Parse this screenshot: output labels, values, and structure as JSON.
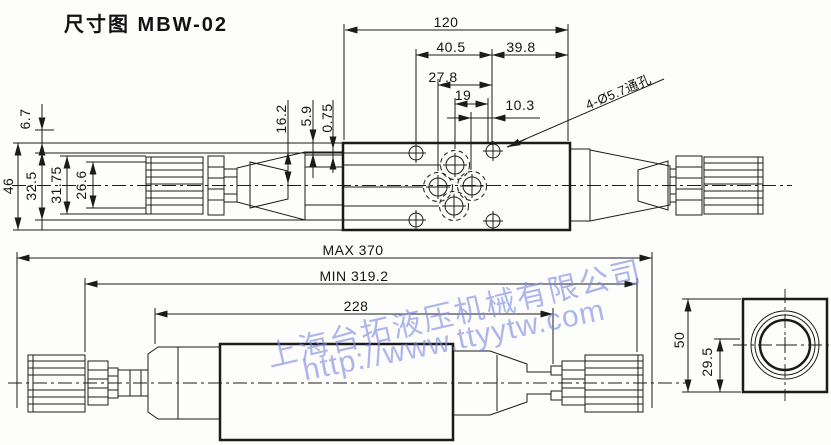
{
  "title": "尺寸图 MBW-02",
  "top_view": {
    "dim_120": "120",
    "dim_40_5": "40.5",
    "dim_39_8": "39.8",
    "dim_27_8": "27.8",
    "dim_19": "19",
    "dim_10_3": "10.3",
    "dim_6_7": "6.7",
    "dim_46": "46",
    "dim_32_5": "32.5",
    "dim_31_75": "31.75",
    "dim_26_6": "26.6",
    "dim_16_2": "16.2",
    "dim_5_9": "5.9",
    "dim_0_75": "0.75",
    "hole_note": "4-Ø5.7通孔"
  },
  "side_view": {
    "dim_max": "MAX 370",
    "dim_min": "MIN 319.2",
    "dim_228": "228"
  },
  "end_view": {
    "dim_50": "50",
    "dim_29_5": "29.5"
  },
  "watermark": {
    "company": "上海台拓液压机械有限公司",
    "url": "http://www.ttyytw.com",
    "color": "#7a8be2"
  }
}
